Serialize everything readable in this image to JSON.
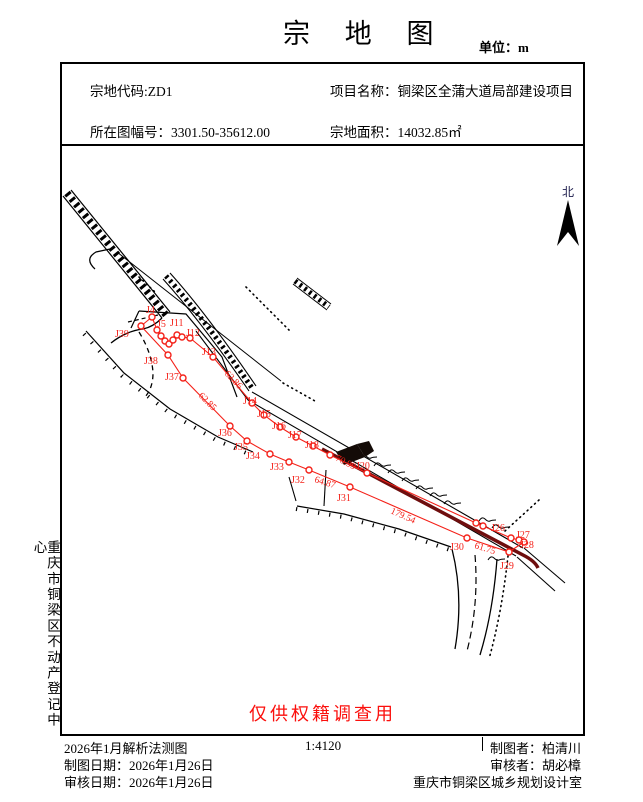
{
  "header": {
    "title": "宗 地 图",
    "unit": "单位：m"
  },
  "info": {
    "parcel_code": "宗地代码:ZD1",
    "project_name": "项目名称：铜梁区全蒲大道局部建设项目",
    "sheet_no": "所在图幅号：3301.50-35612.00",
    "area": "宗地面积：14032.85㎡"
  },
  "sidebar": {
    "text": "重庆市铜梁区不动产登记中心"
  },
  "map": {
    "north": "北",
    "watermark": "仅供权籍调查用",
    "points": [
      [
        152,
        317
      ],
      [
        141,
        326
      ],
      [
        157,
        330
      ],
      [
        161,
        336
      ],
      [
        165,
        341
      ],
      [
        169,
        344
      ],
      [
        173,
        340
      ],
      [
        177,
        335
      ],
      [
        182,
        337
      ],
      [
        190,
        338
      ],
      [
        213,
        357
      ],
      [
        252,
        403
      ],
      [
        264,
        415
      ],
      [
        280,
        427
      ],
      [
        296,
        437
      ],
      [
        313,
        446
      ],
      [
        330,
        455
      ],
      [
        367,
        473
      ],
      [
        476,
        523
      ],
      [
        483,
        526
      ],
      [
        511,
        538
      ],
      [
        519,
        540
      ],
      [
        524,
        542
      ],
      [
        509,
        552
      ],
      [
        467,
        538
      ],
      [
        350,
        487
      ],
      [
        309,
        470
      ],
      [
        289,
        462
      ],
      [
        270,
        454
      ],
      [
        247,
        441
      ],
      [
        230,
        426
      ],
      [
        183,
        378
      ],
      [
        168,
        355
      ]
    ],
    "boundaries": [
      [
        [
          152,
          317
        ],
        [
          157,
          330
        ],
        [
          161,
          336
        ],
        [
          165,
          341
        ],
        [
          169,
          344
        ],
        [
          173,
          340
        ],
        [
          177,
          335
        ],
        [
          182,
          337
        ],
        [
          190,
          338
        ],
        [
          213,
          357
        ],
        [
          252,
          403
        ],
        [
          264,
          415
        ],
        [
          280,
          427
        ],
        [
          296,
          437
        ],
        [
          313,
          446
        ],
        [
          330,
          455
        ],
        [
          367,
          473
        ],
        [
          476,
          523
        ],
        [
          483,
          526
        ],
        [
          511,
          538
        ],
        [
          519,
          540
        ],
        [
          524,
          542
        ]
      ],
      [
        [
          141,
          326
        ],
        [
          152,
          317
        ]
      ],
      [
        [
          141,
          326
        ],
        [
          168,
          355
        ],
        [
          183,
          378
        ],
        [
          230,
          426
        ],
        [
          247,
          441
        ],
        [
          270,
          454
        ],
        [
          289,
          462
        ],
        [
          309,
          470
        ],
        [
          350,
          487
        ],
        [
          467,
          538
        ],
        [
          509,
          552
        ],
        [
          524,
          542
        ]
      ]
    ],
    "point_labels": [
      {
        "t": "J4",
        "x": 146,
        "y": 313
      },
      {
        "t": "J5",
        "x": 157,
        "y": 327
      },
      {
        "t": "J11",
        "x": 170,
        "y": 326
      },
      {
        "t": "J12",
        "x": 186,
        "y": 336
      },
      {
        "t": "J13",
        "x": 202,
        "y": 355
      },
      {
        "t": "J14",
        "x": 243,
        "y": 404
      },
      {
        "t": "J15",
        "x": 257,
        "y": 417
      },
      {
        "t": "J16",
        "x": 272,
        "y": 429
      },
      {
        "t": "J17",
        "x": 288,
        "y": 438
      },
      {
        "t": "J18",
        "x": 305,
        "y": 448
      },
      {
        "t": "J20",
        "x": 356,
        "y": 469
      },
      {
        "t": "J26",
        "x": 491,
        "y": 531
      },
      {
        "t": "J27",
        "x": 516,
        "y": 538
      },
      {
        "t": "J28",
        "x": 520,
        "y": 548
      },
      {
        "t": "J29",
        "x": 500,
        "y": 569
      },
      {
        "t": "J30",
        "x": 450,
        "y": 550
      },
      {
        "t": "J31",
        "x": 337,
        "y": 501
      },
      {
        "t": "J32",
        "x": 291,
        "y": 483
      },
      {
        "t": "J33",
        "x": 270,
        "y": 470
      },
      {
        "t": "J34",
        "x": 246,
        "y": 459
      },
      {
        "t": "J35",
        "x": 234,
        "y": 450
      },
      {
        "t": "J36",
        "x": 218,
        "y": 436
      },
      {
        "t": "J37",
        "x": 165,
        "y": 380
      },
      {
        "t": "J38",
        "x": 144,
        "y": 364
      },
      {
        "t": "J39",
        "x": 115,
        "y": 337
      }
    ],
    "distance_labels": [
      {
        "t": "62.86",
        "x": 224,
        "y": 374,
        "a": 46
      },
      {
        "t": "62.85",
        "x": 198,
        "y": 396,
        "a": 45
      },
      {
        "t": "70.99",
        "x": 335,
        "y": 460,
        "a": 27
      },
      {
        "t": "64.87",
        "x": 314,
        "y": 482,
        "a": 17
      },
      {
        "t": "179.54",
        "x": 390,
        "y": 513,
        "a": 24
      },
      {
        "t": "61.75",
        "x": 474,
        "y": 548,
        "a": 17
      }
    ]
  },
  "footer": {
    "method": "2026年1月解析法测图",
    "scale": "1:4120",
    "drafter": "制图者：柏清川",
    "draft_date": "制图日期：2026年1月26日",
    "reviewer": "审核者：胡必樟",
    "review_date": "审核日期：2026年1月26日",
    "org": "重庆市铜梁区城乡规划设计室"
  },
  "colors": {
    "red": "#f42119",
    "watermark_red": "#fb0f0c",
    "dark_road": "#6e0e0e",
    "black": "#000000"
  }
}
